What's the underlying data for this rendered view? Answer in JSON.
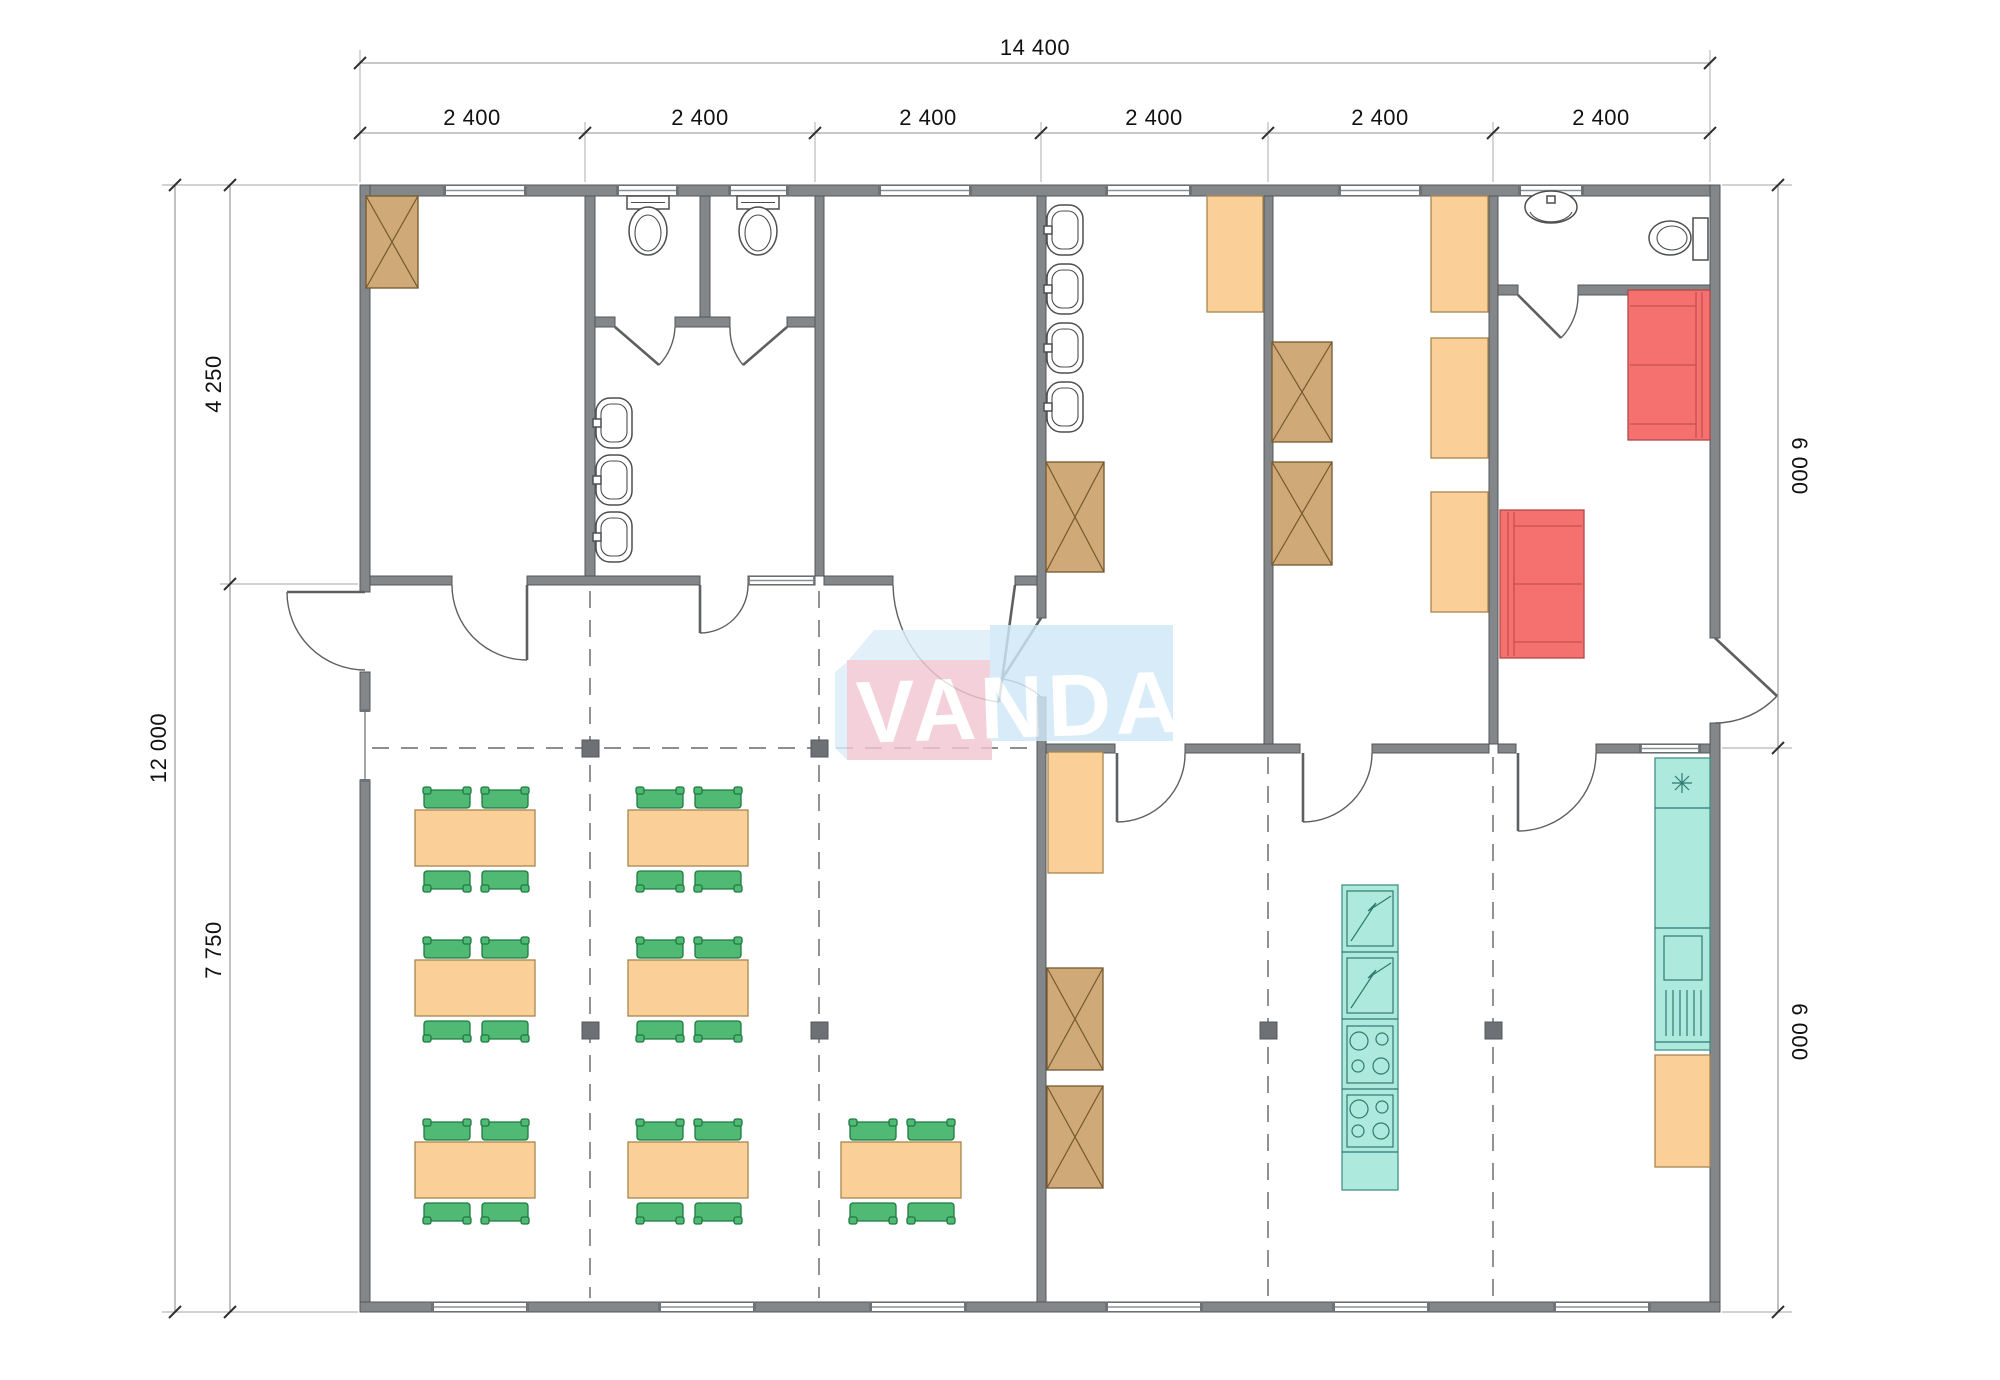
{
  "drawing": {
    "kind": "modular building floor plan",
    "canvas": {
      "width": 2000,
      "height": 1380
    }
  },
  "dimensions": {
    "top_total": "14 400",
    "top_segments": [
      "2 400",
      "2 400",
      "2 400",
      "2 400",
      "2 400",
      "2 400"
    ],
    "left_total": "12 000",
    "left_upper": "4 250",
    "left_lower": "7 750",
    "right_upper": "6 000",
    "right_lower": "6 000"
  },
  "watermark": {
    "text": "VANDA",
    "pink": "#f2c6d2",
    "blue": "#cfe8f7",
    "text_color": "#ffffff"
  },
  "colors": {
    "wall": "#84878a",
    "table_and_lockers": "#fbcf98",
    "chairs": "#50b974",
    "wardrobes": "#cfa977",
    "sofas": "#f4716f",
    "kitchen_units": "#aee9dd",
    "grid_dashes": "#7c7f82"
  },
  "furniture_inventory": {
    "dining_tables": 7,
    "chairs": 28,
    "tan_wardrobes": 6,
    "orange_units": 6,
    "sofas": 2,
    "toilets": 3,
    "wash_basins": 8,
    "pedestal_sinks": 1,
    "fridges": 2,
    "stoves": 2,
    "column_markers": 6
  }
}
